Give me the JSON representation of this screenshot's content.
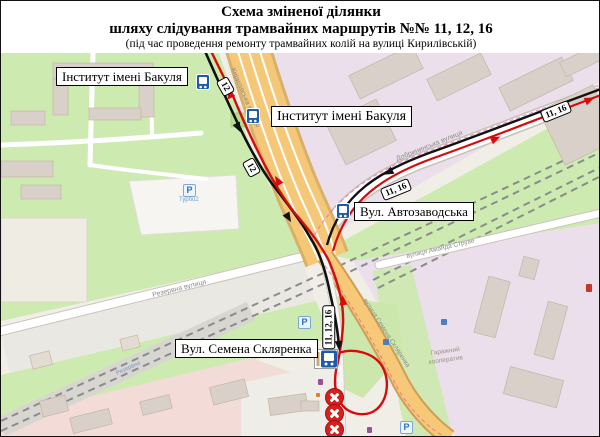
{
  "header": {
    "title_line1": "Схема зміненої ділянки",
    "title_line2": "шляху слідування трамвайних маршрутів №№ 11, 12, 16",
    "subtitle": "(під час проведення ремонту трамвайних колій на вулиці Кирилівській)"
  },
  "routes": {
    "numbers_affected": "11, 12, 16",
    "color_changed_route": "#d60b0b",
    "color_regular_route": "#111111",
    "color_closed_marker": "#d81f1f",
    "color_stop_sign": "#1d5ca8"
  },
  "stop_labels": [
    {
      "text": "Інститут імені Бакуля"
    },
    {
      "text": "Інститут імені Бакуля"
    },
    {
      "text": "Вул. Автозаводська"
    },
    {
      "text": "Вул. Семена Скляренка"
    }
  ],
  "route_badges": [
    {
      "text": "12"
    },
    {
      "text": "12"
    },
    {
      "text": "11, 16"
    },
    {
      "text": "11, 16"
    },
    {
      "text": "11, 12, 16"
    }
  ],
  "street_names": {
    "kyrylivska": "Кирилівська вулиця",
    "dobryninska": "Добрининська вулиця",
    "sklyarenka": "вулиця Семена Скляренка",
    "struve": "вулиця Аманда Струве",
    "rezervna": "Резервна вулиця",
    "rezervna_platform": "Резервна",
    "garage_line1": "Гаражний",
    "garage_line2": "кооператив",
    "parking_caption": "Турбо2"
  },
  "icons": {
    "parking_letter": "P"
  }
}
